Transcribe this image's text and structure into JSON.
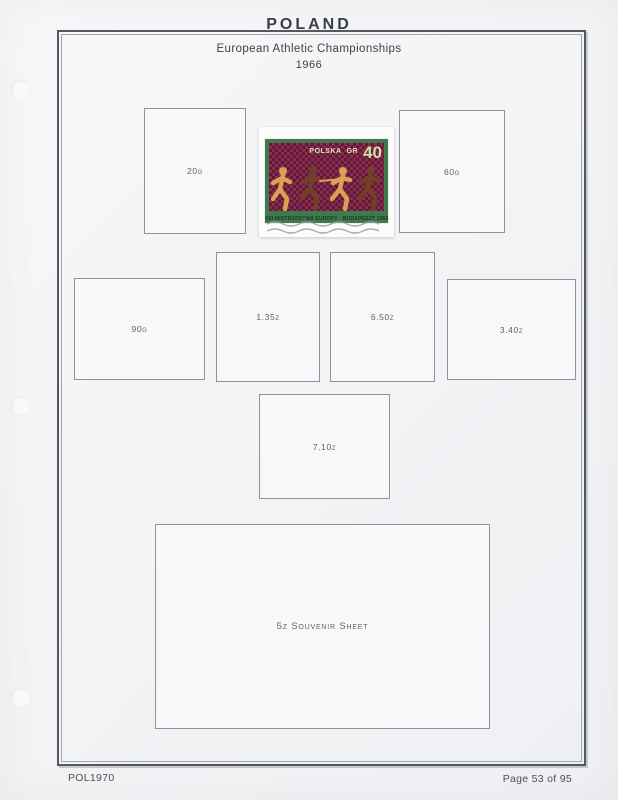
{
  "page": {
    "title": "POLAND",
    "subtitle": "European Athletic Championships",
    "year": "1966",
    "footer_left": "POL1970",
    "footer_right": "Page 53 of 95"
  },
  "stamp": {
    "country": "POLSKA",
    "currency": "GR",
    "denomination": "40",
    "inscription": "VIII MISTRZOSTWA EUROPY · BUDAPESZT 1966",
    "colors": {
      "frame_green": "#41794e",
      "field_red": "#8e2950",
      "field_red_dark": "#5c1b36",
      "numeral_green": "#cfe3a0",
      "runner_gold": "#d8a355",
      "runner_dark": "#6f4226"
    }
  },
  "placeholders": [
    {
      "label": "20g"
    },
    {
      "label": "60g"
    },
    {
      "label": "90g"
    },
    {
      "label": "1.35z"
    },
    {
      "label": "6.50z"
    },
    {
      "label": "3.40z"
    },
    {
      "label": "7.10z"
    },
    {
      "label": "5z Souvenir Sheet"
    }
  ]
}
